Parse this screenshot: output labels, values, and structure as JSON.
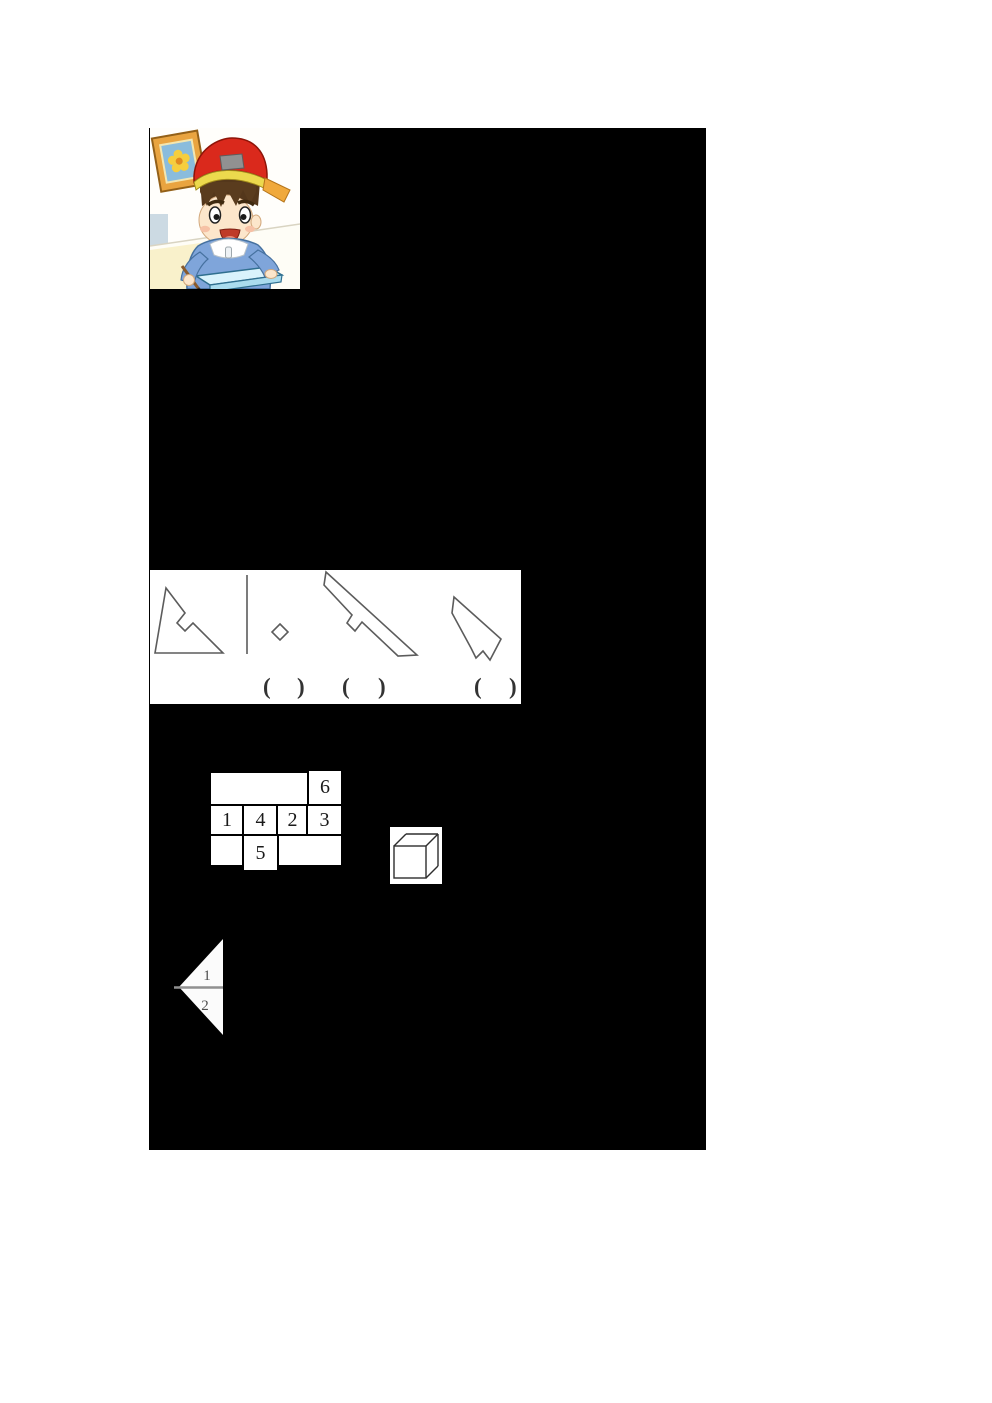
{
  "page": {
    "background": "#ffffff"
  },
  "colors": {
    "panel": "#000000",
    "shape_outline": "#5c5c5c",
    "grid_border": "#000000",
    "digit": "#1a1a1a",
    "fold_divider": "#909090"
  },
  "icons": {
    "illustration": "boy-drawing-illustration",
    "cube": "cube-line-drawing",
    "divider": "vertical-divider-line",
    "diamond": "small-diamond-shape"
  },
  "angle_question": {
    "paren_open": "(",
    "paren_close": ")"
  },
  "net_grid": {
    "cell1": "1",
    "cell2": "2",
    "cell3": "3",
    "cell4": "4",
    "cell5": "5",
    "cell6": "6"
  },
  "fold_figure": {
    "part1": "1",
    "part2": "2"
  }
}
